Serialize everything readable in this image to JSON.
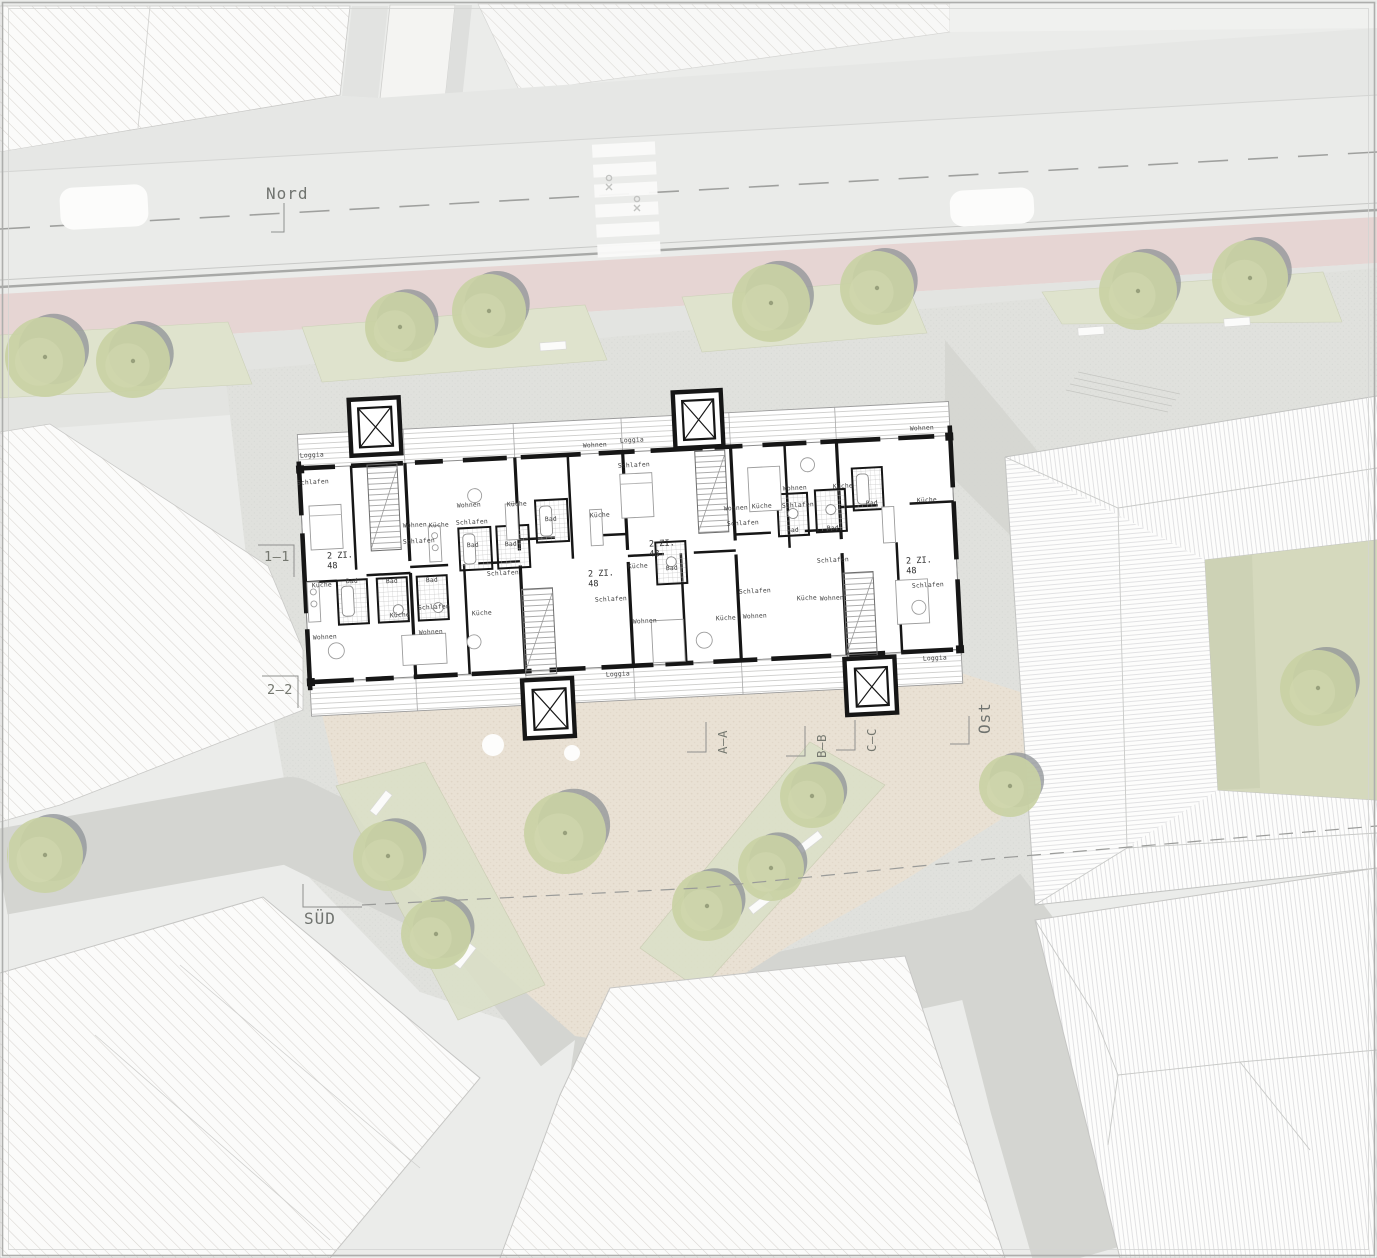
{
  "meta": {
    "title": "Architektur Lageplan / Grundriss Erdgeschoss"
  },
  "colors": {
    "ground": "#ebecea",
    "street": "#eaebe9",
    "bike_lane": "#e6d5d3",
    "verge_green": "#dfe3cd",
    "strip_green": "#dbe0c8",
    "plaza": "#e9e1d4",
    "promenade": "#e0e1dd",
    "path_dark": "#d4d5d1",
    "courtyard": "#d5d9bd",
    "tree": "#c9d1a4",
    "tree_shadow": "#8e9295",
    "wall": "#161616",
    "label": "#70736f",
    "hatch": "#d6d3cf"
  },
  "orientation_labels": [
    {
      "id": "north",
      "text": "Nord",
      "x": 266,
      "y": 199,
      "rotation": 0,
      "leader": "M284,203 V232 H271"
    },
    {
      "id": "south",
      "text": "SÜD",
      "x": 304,
      "y": 924,
      "rotation": 0,
      "leader": "M303,884 V907 H362"
    },
    {
      "id": "east",
      "text": "Ost",
      "x": 990,
      "y": 734,
      "rotation": -90,
      "leader": "M969,716 V744 H950"
    }
  ],
  "section_markers_horizontal": [
    {
      "label": "1–1",
      "x": 277,
      "y": 561,
      "leader": "M258,545 H294 V577"
    },
    {
      "label": "2–2",
      "x": 280,
      "y": 694,
      "leader": "M262,676 H298 V708"
    }
  ],
  "section_markers_vertical": [
    {
      "label": "A–A",
      "x": 727,
      "y": 742,
      "leader": "M706,722 V752 H687"
    },
    {
      "label": "B–B",
      "x": 826,
      "y": 746,
      "leader": "M805,726 V756 H786"
    },
    {
      "label": "C–C",
      "x": 876,
      "y": 740,
      "leader": "M855,720 V750 H836"
    }
  ],
  "plan": {
    "rotation_deg": -2.9,
    "pivot_x": 627,
    "pivot_y": 558,
    "apartment_labels": [
      {
        "line1": "2 ZI.",
        "line2": "48",
        "x": 340,
        "y": 558
      },
      {
        "line1": "2 ZI.",
        "line2": "48",
        "x": 601,
        "y": 576
      },
      {
        "line1": "2 ZI.",
        "line2": "48",
        "x": 662,
        "y": 546
      },
      {
        "line1": "2 ZI.",
        "line2": "48",
        "x": 919,
        "y": 563
      }
    ],
    "room_labels": [
      {
        "t": "Loggia",
        "x": 312,
        "y": 457
      },
      {
        "t": "Schlafen",
        "x": 313,
        "y": 484
      },
      {
        "t": "Küche",
        "x": 322,
        "y": 587
      },
      {
        "t": "Wohnen",
        "x": 325,
        "y": 639
      },
      {
        "t": "Wohnen",
        "x": 415,
        "y": 527
      },
      {
        "t": "Küche",
        "x": 439,
        "y": 527
      },
      {
        "t": "Schlafen",
        "x": 419,
        "y": 543
      },
      {
        "t": "Bad",
        "x": 352,
        "y": 583
      },
      {
        "t": "Bad",
        "x": 392,
        "y": 583
      },
      {
        "t": "Bad",
        "x": 432,
        "y": 582
      },
      {
        "t": "Küche",
        "x": 400,
        "y": 617
      },
      {
        "t": "Schlafen",
        "x": 434,
        "y": 609
      },
      {
        "t": "Wohnen",
        "x": 431,
        "y": 634
      },
      {
        "t": "Wohnen",
        "x": 469,
        "y": 507
      },
      {
        "t": "Schlafen",
        "x": 472,
        "y": 524
      },
      {
        "t": "Bad",
        "x": 473,
        "y": 547
      },
      {
        "t": "Küche",
        "x": 517,
        "y": 506
      },
      {
        "t": "Bad",
        "x": 511,
        "y": 546
      },
      {
        "t": "Schlafen",
        "x": 503,
        "y": 575
      },
      {
        "t": "Küche",
        "x": 482,
        "y": 615
      },
      {
        "t": "Bad",
        "x": 551,
        "y": 521
      },
      {
        "t": "Küche",
        "x": 600,
        "y": 517
      },
      {
        "t": "Wohnen",
        "x": 595,
        "y": 447
      },
      {
        "t": "Loggia",
        "x": 632,
        "y": 442
      },
      {
        "t": "Schlafen",
        "x": 634,
        "y": 467
      },
      {
        "t": "Küche",
        "x": 638,
        "y": 568
      },
      {
        "t": "Bad",
        "x": 672,
        "y": 570
      },
      {
        "t": "Schlafen",
        "x": 611,
        "y": 601
      },
      {
        "t": "Wohnen",
        "x": 645,
        "y": 623
      },
      {
        "t": "Loggia",
        "x": 618,
        "y": 676
      },
      {
        "t": "Wohnen",
        "x": 736,
        "y": 510
      },
      {
        "t": "Küche",
        "x": 762,
        "y": 508
      },
      {
        "t": "Schlafen",
        "x": 743,
        "y": 525
      },
      {
        "t": "Wohnen",
        "x": 795,
        "y": 490
      },
      {
        "t": "Schlafen",
        "x": 798,
        "y": 507
      },
      {
        "t": "Bad",
        "x": 793,
        "y": 532
      },
      {
        "t": "Bad",
        "x": 833,
        "y": 530
      },
      {
        "t": "Küche",
        "x": 843,
        "y": 488
      },
      {
        "t": "Schlafen",
        "x": 833,
        "y": 562
      },
      {
        "t": "Küche",
        "x": 807,
        "y": 600
      },
      {
        "t": "Wohnen",
        "x": 832,
        "y": 600
      },
      {
        "t": "Schlafen",
        "x": 755,
        "y": 593
      },
      {
        "t": "Küche",
        "x": 726,
        "y": 620
      },
      {
        "t": "Wohnen",
        "x": 755,
        "y": 618
      },
      {
        "t": "Wohnen",
        "x": 922,
        "y": 430
      },
      {
        "t": "Bad",
        "x": 872,
        "y": 505
      },
      {
        "t": "Küche",
        "x": 927,
        "y": 502
      },
      {
        "t": "Schlafen",
        "x": 928,
        "y": 587
      },
      {
        "t": "Loggia",
        "x": 935,
        "y": 660
      }
    ]
  },
  "site": {
    "trees_street": [
      {
        "x": 45,
        "y": 357,
        "r": 40
      },
      {
        "x": 133,
        "y": 361,
        "r": 37
      },
      {
        "x": 400,
        "y": 327,
        "r": 35
      },
      {
        "x": 489,
        "y": 311,
        "r": 37
      },
      {
        "x": 771,
        "y": 303,
        "r": 39
      },
      {
        "x": 877,
        "y": 288,
        "r": 37
      },
      {
        "x": 1138,
        "y": 291,
        "r": 39
      },
      {
        "x": 1250,
        "y": 278,
        "r": 38
      }
    ],
    "trees_plaza": [
      {
        "x": 565,
        "y": 833,
        "r": 41
      },
      {
        "x": 388,
        "y": 856,
        "r": 35
      },
      {
        "x": 436,
        "y": 934,
        "r": 35
      },
      {
        "x": 707,
        "y": 906,
        "r": 35
      },
      {
        "x": 771,
        "y": 868,
        "r": 33
      },
      {
        "x": 812,
        "y": 796,
        "r": 32
      },
      {
        "x": 1010,
        "y": 786,
        "r": 31
      },
      {
        "x": 45,
        "y": 855,
        "r": 38
      }
    ],
    "trees_courtyard": [
      {
        "x": 1318,
        "y": 688,
        "r": 38
      }
    ],
    "cars": [
      {
        "x": 60,
        "y": 186,
        "w": 88,
        "h": 42
      },
      {
        "x": 950,
        "y": 189,
        "w": 84,
        "h": 36
      }
    ],
    "crosswalk": {
      "x": 595,
      "y": 143,
      "count": 6,
      "w": 63,
      "h": 13,
      "gap": 7
    },
    "lamps": [
      {
        "x": 493,
        "y": 745,
        "r": 11
      },
      {
        "x": 572,
        "y": 753,
        "r": 8
      }
    ],
    "benches": [
      {
        "x": 368,
        "y": 799,
        "a": -52
      },
      {
        "x": 452,
        "y": 952,
        "a": -52
      },
      {
        "x": 797,
        "y": 838,
        "a": -38
      },
      {
        "x": 748,
        "y": 899,
        "a": -38
      },
      {
        "x": 1078,
        "y": 327,
        "a": -4
      },
      {
        "x": 1224,
        "y": 318,
        "a": -4
      },
      {
        "x": 386,
        "y": 351,
        "a": -4
      },
      {
        "x": 540,
        "y": 342,
        "a": -4
      }
    ]
  }
}
